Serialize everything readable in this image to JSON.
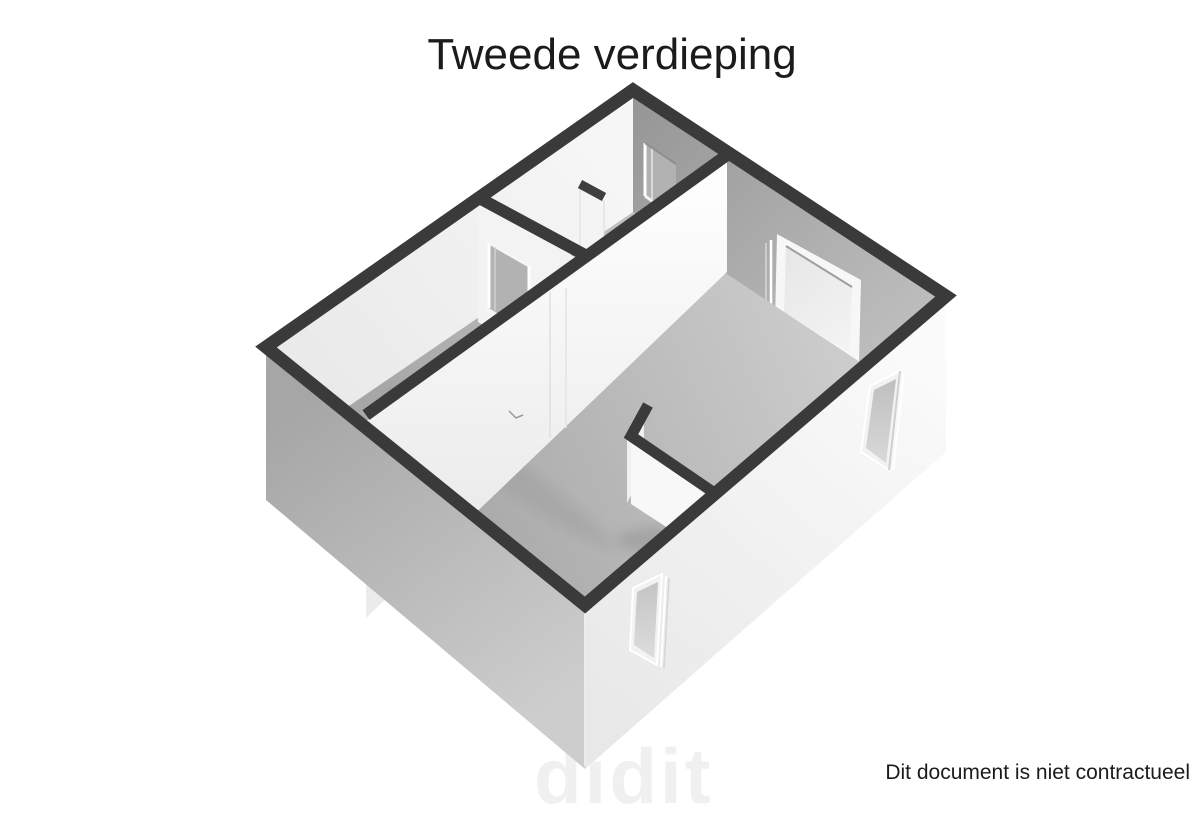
{
  "page": {
    "title": "Tweede verdieping",
    "disclaimer": "Dit document is niet contractueel",
    "watermark": "didit",
    "background_color": "#ffffff",
    "language": "nl"
  },
  "floorplan": {
    "type": "3d-floorplan-render",
    "floor_label": "Tweede verdieping",
    "view": "isometric-birdseye",
    "rooms_visible": 3,
    "colors": {
      "wall_top_band": "#3a3a3a",
      "wall_face_lit": "#f5f5f5",
      "wall_face_shaded": "#b3b3b3",
      "floor": "#bdbdbd",
      "window_glass": "#cfcfcf",
      "text": "#1b1b1b",
      "watermark": "#f0f0f0"
    },
    "features": {
      "windows": [
        {
          "id": "window-ne-wall",
          "location": "north-east wall inner face",
          "shape": "square"
        },
        {
          "id": "window-se-wall-east",
          "location": "south-east exterior wall near east corner",
          "shape": "tall-narrow"
        },
        {
          "id": "window-se-wall-south",
          "location": "south-east exterior wall near south corner",
          "shape": "tall-narrow"
        }
      ],
      "doorways": [
        {
          "id": "doorway-ne-wall",
          "location": "north-east wall, top room (stair opening)"
        },
        {
          "id": "doorway-wall-b",
          "location": "interior wall between top room and left room"
        },
        {
          "id": "doorway-wall-c",
          "location": "long interior wall near junction, with open door leaf"
        }
      ],
      "other": [
        {
          "id": "stair-enclosure-wall",
          "description": "L-shaped low wall in large room"
        }
      ]
    }
  }
}
